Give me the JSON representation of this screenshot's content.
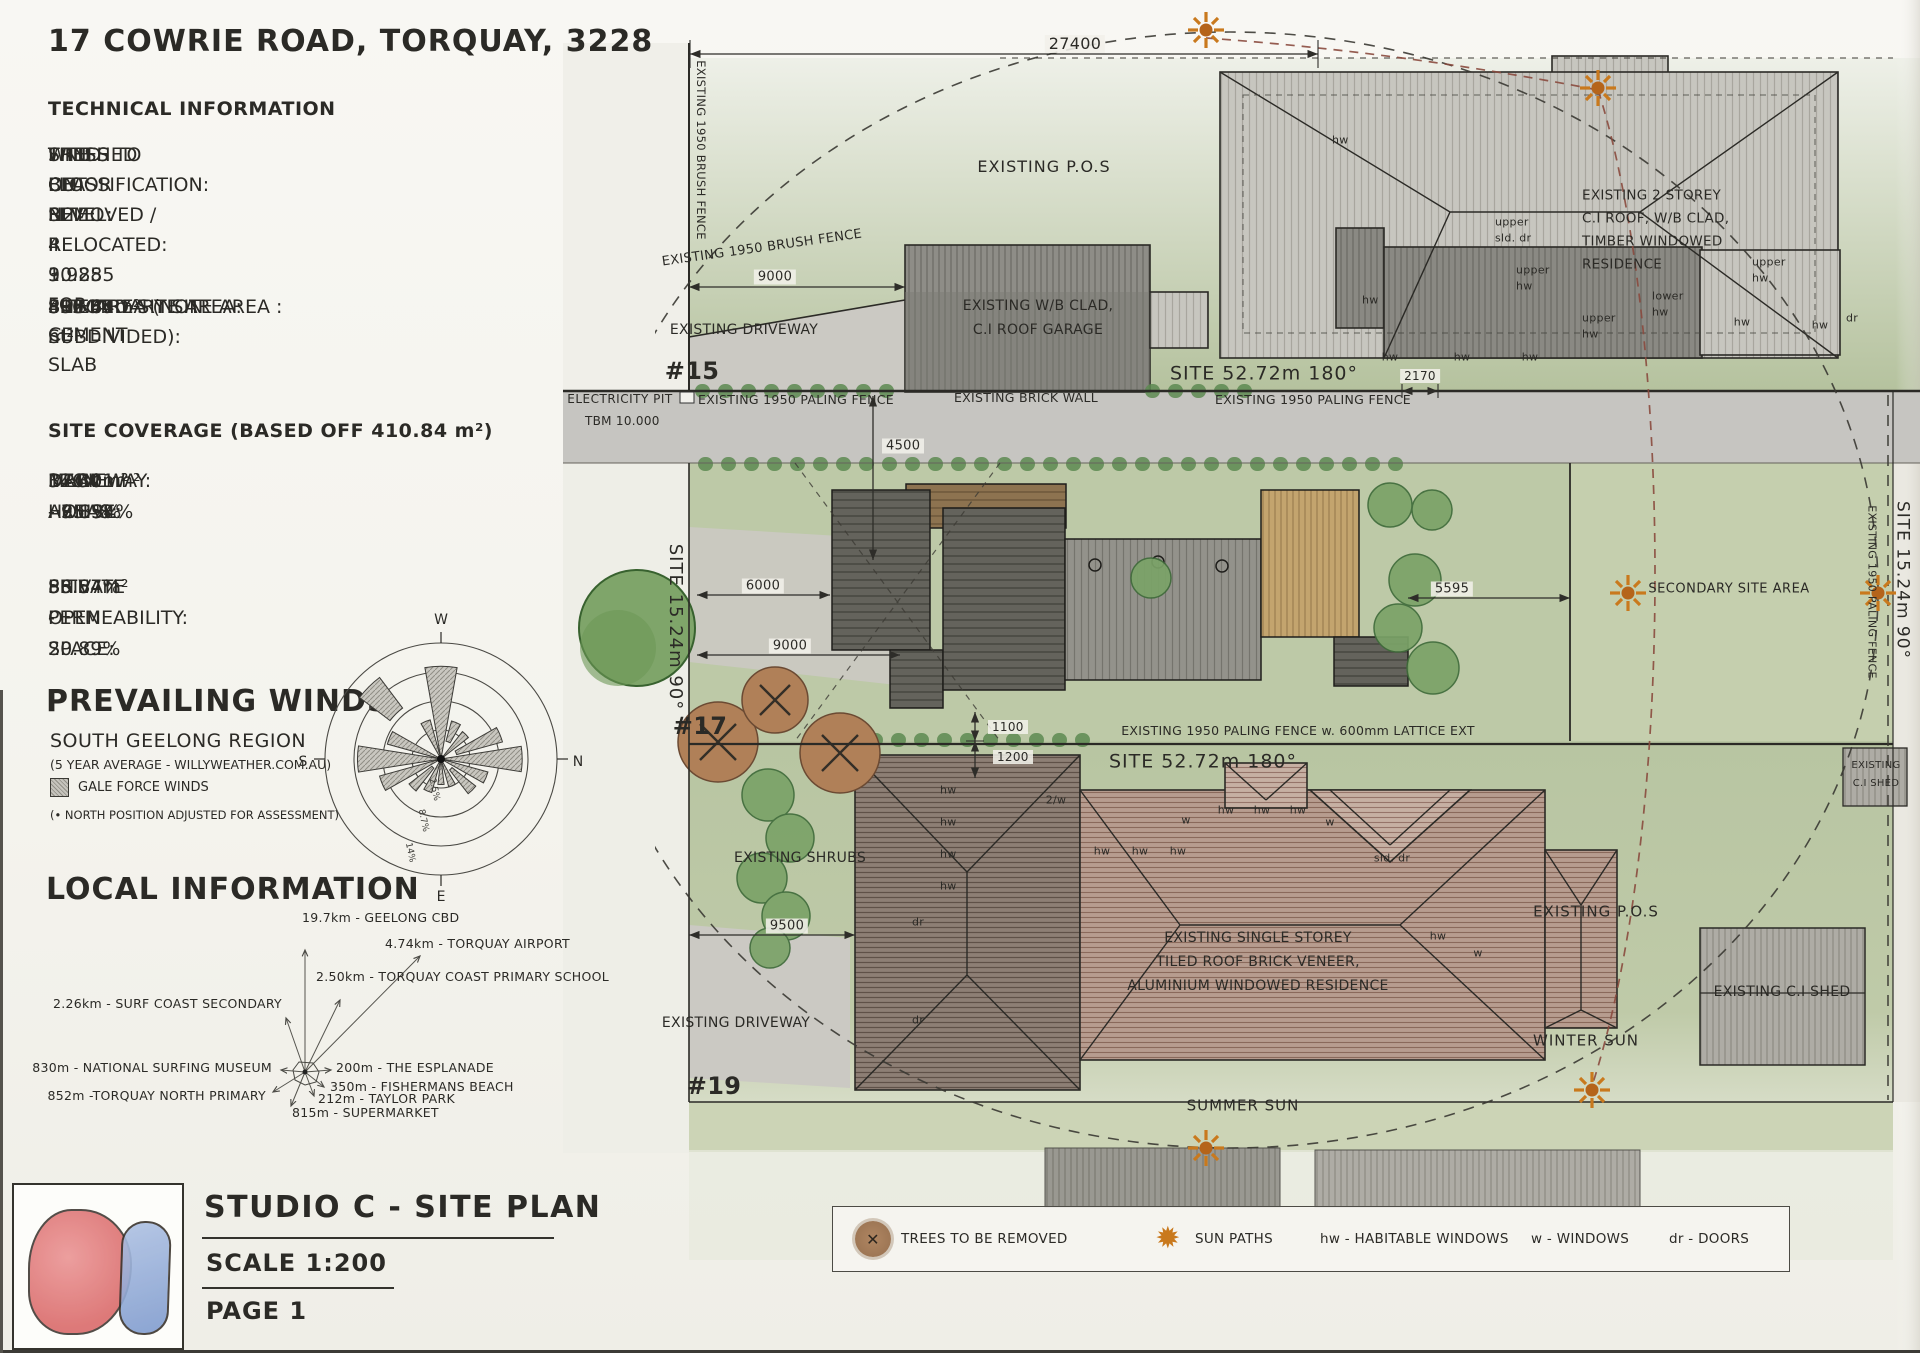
{
  "colors": {
    "paper": "#f6f5f0",
    "ink": "#2b2a26",
    "grass": "#bdc9a7",
    "grass_secondary": "#c5cfae",
    "road": "#c6c5c1",
    "driveway": "#cbc9c3",
    "sun": "#c9791d",
    "sun_core": "#b5641a",
    "sun_path_red": "#8a4a3e",
    "boundary": "#2e2d29",
    "tree_green": "#7fa56a",
    "tree_removed": "#b08058",
    "logo_red": "#db6e6e",
    "logo_blue": "#8fa8d8",
    "legend_bg": "#f4f3ee"
  },
  "sheet": {
    "address_title": "17 COWRIE ROAD, TORQUAY, 3228",
    "technical": {
      "heading": "TECHNICAL INFORMATION",
      "lines": [
        "WIND CLASSIFICATION: N2",
        "SITE CUT LEVEL: RL 9.985 FOR CEMENT SLAB",
        "FINISHED FLOOR LEVEL: RL 10.285",
        "TREES ON SITE: 4",
        "TREES TO BE REMOVED / RELOCATED: 3"
      ]
    },
    "site_areas": {
      "rows": [
        {
          "label": "SITE AREA (NON SUBDIVIDED):",
          "value": "803.45 m²"
        },
        {
          "label": "PRIMARY SITE AREA:",
          "value": "410.84 m²"
        },
        {
          "label": "SECONDARY SITE AREA :",
          "value": "392.61m²"
        }
      ]
    },
    "site_coverage": {
      "heading": "SITE COVERAGE (BASED OFF 410.84 m²)",
      "rows": [
        {
          "label": "MAIN HOUSE:",
          "value": "146.01m² - 35.54%"
        },
        {
          "label": "DECK AREAS:",
          "value": "37.37m² - 9.1%"
        },
        {
          "label": "DRIVEWAY:",
          "value": "32.40m² - 7.89%"
        }
      ],
      "summary_rows": [
        {
          "label": "SITE PERMEABILITY:",
          "value": "56.57%"
        },
        {
          "label": "PRIVATE OPEN SPACE:",
          "value": "85.84m² - 20.89%"
        }
      ]
    },
    "prevailing_winds": {
      "heading": "PREVAILING WINDS",
      "region": "SOUTH GEELONG REGION",
      "source": "(5 YEAR AVERAGE - WILLYWEATHER.COM.AU)",
      "gale_legend": "GALE FORCE WINDS",
      "note": "(• NORTH POSITION ADJUSTED FOR ASSESSMENT)"
    },
    "local_information": {
      "heading": "LOCAL INFORMATION",
      "places": [
        {
          "text": "19.7km - GEELONG CBD",
          "x": 302,
          "y": 918,
          "anchor": "start"
        },
        {
          "text": "4.74km - TORQUAY AIRPORT",
          "x": 385,
          "y": 944,
          "anchor": "start"
        },
        {
          "text": "2.50km - TORQUAY COAST PRIMARY SCHOOL",
          "x": 316,
          "y": 977,
          "anchor": "start"
        },
        {
          "text": "2.26km - SURF COAST SECONDARY",
          "x": 282,
          "y": 1004,
          "anchor": "end"
        },
        {
          "text": "830m - NATIONAL SURFING MUSEUM",
          "x": 272,
          "y": 1068,
          "anchor": "end"
        },
        {
          "text": "200m - THE ESPLANADE",
          "x": 336,
          "y": 1068,
          "anchor": "start"
        },
        {
          "text": "350m - FISHERMANS BEACH",
          "x": 330,
          "y": 1087,
          "anchor": "start"
        },
        {
          "text": "852m -TORQUAY NORTH PRIMARY",
          "x": 266,
          "y": 1096,
          "anchor": "end"
        },
        {
          "text": "212m - TAYLOR PARK",
          "x": 318,
          "y": 1099,
          "anchor": "start"
        },
        {
          "text": "815m - SUPERMARKET",
          "x": 292,
          "y": 1113,
          "anchor": "start"
        }
      ]
    },
    "title_block": {
      "project": "STUDIO C - SITE PLAN",
      "scale": "SCALE 1:200",
      "page": "PAGE 1"
    }
  },
  "wind_rose": {
    "type": "wind-rose",
    "compass": [
      {
        "label": "W",
        "x": 441,
        "y": 624
      },
      {
        "label": "N",
        "x": 578,
        "y": 766
      },
      {
        "label": "E",
        "x": 441,
        "y": 901
      },
      {
        "label": "S",
        "x": 303,
        "y": 766
      }
    ],
    "ring_labels": [
      {
        "t": "2.5%",
        "x": 432,
        "y": 790,
        "r": 78
      },
      {
        "t": "8.7%",
        "x": 421,
        "y": 821,
        "r": 78
      },
      {
        "t": "14%",
        "x": 408,
        "y": 853,
        "r": 78
      }
    ],
    "petals": [
      {
        "a": 0,
        "w": 20,
        "r1": 0.8
      },
      {
        "a": 22.5,
        "r0": 0.16,
        "r1": 0.34
      },
      {
        "a": 45,
        "r1": 0.3
      },
      {
        "a": 67.5,
        "r0": 0.14,
        "r1": 0.55
      },
      {
        "a": 90,
        "w": 18,
        "r1": 0.7
      },
      {
        "a": 112.5,
        "r1": 0.42
      },
      {
        "a": 135,
        "r0": 0.12,
        "r1": 0.38
      },
      {
        "a": 157.5,
        "r1": 0.25
      },
      {
        "a": 180,
        "r1": 0.22
      },
      {
        "a": 202.5,
        "r1": 0.3
      },
      {
        "a": 225,
        "r0": 0.1,
        "r1": 0.35
      },
      {
        "a": 247.5,
        "r1": 0.55
      },
      {
        "a": 270,
        "w": 18,
        "r1": 0.72
      },
      {
        "a": 292.5,
        "r1": 0.48
      },
      {
        "a": 315,
        "w": 16,
        "r0": 0.55,
        "r1": 0.88
      },
      {
        "a": 337.5,
        "r1": 0.35
      }
    ]
  },
  "legend": {
    "items": [
      {
        "icon": "removed-tree",
        "label": "TREES TO BE REMOVED",
        "x": 22
      },
      {
        "icon": "sun",
        "label": "SUN PATHS",
        "x": 318
      },
      {
        "label": "hw - HABITABLE WINDOWS",
        "x": 487
      },
      {
        "label": "w - WINDOWS",
        "x": 698
      },
      {
        "label": "dr - DOORS",
        "x": 836
      }
    ]
  },
  "plan": {
    "labels": [
      {
        "t": "27400",
        "x": 1075,
        "y": 44,
        "fs": 16,
        "c": "dim"
      },
      {
        "t": "EXISTING P.O.S",
        "x": 1044,
        "y": 167,
        "fs": 16,
        "ls": 1
      },
      {
        "t": "EXISTING 1950 BRUSH FENCE",
        "x": 700,
        "y": 150,
        "fs": 11.5,
        "r": 90
      },
      {
        "t": "EXISTING 1950 BRUSH FENCE",
        "x": 762,
        "y": 248,
        "fs": 13,
        "r": -8
      },
      {
        "t": "9000",
        "x": 775,
        "y": 277,
        "fs": 13,
        "c": "dim"
      },
      {
        "t": "EXISTING DRIVEWAY",
        "x": 744,
        "y": 330,
        "fs": 14
      },
      {
        "t": "EXISTING W/B CLAD,",
        "x": 1038,
        "y": 306,
        "fs": 14
      },
      {
        "t": "C.I ROOF GARAGE",
        "x": 1038,
        "y": 330,
        "fs": 14
      },
      {
        "t": "EXISTING 2 STOREY",
        "x": 1582,
        "y": 196,
        "fs": 13.5,
        "a": "start"
      },
      {
        "t": "C.I ROOF, W/B CLAD,",
        "x": 1582,
        "y": 219,
        "fs": 13.5,
        "a": "start"
      },
      {
        "t": "TIMBER WINDOWED",
        "x": 1582,
        "y": 242,
        "fs": 13.5,
        "a": "start"
      },
      {
        "t": "RESIDENCE",
        "x": 1582,
        "y": 265,
        "fs": 13.5,
        "a": "start"
      },
      {
        "t": "hw",
        "x": 1332,
        "y": 140,
        "fs": 11,
        "a": "start"
      },
      {
        "t": "upper",
        "x": 1495,
        "y": 222,
        "fs": 11,
        "a": "start"
      },
      {
        "t": "sld. dr",
        "x": 1495,
        "y": 238,
        "fs": 11,
        "a": "start"
      },
      {
        "t": "upper",
        "x": 1516,
        "y": 270,
        "fs": 11,
        "a": "start"
      },
      {
        "t": "hw",
        "x": 1516,
        "y": 286,
        "fs": 11,
        "a": "start"
      },
      {
        "t": "upper",
        "x": 1752,
        "y": 262,
        "fs": 11,
        "a": "start"
      },
      {
        "t": "hw",
        "x": 1752,
        "y": 278,
        "fs": 11,
        "a": "start"
      },
      {
        "t": "lower",
        "x": 1652,
        "y": 296,
        "fs": 11,
        "a": "start"
      },
      {
        "t": "hw",
        "x": 1652,
        "y": 312,
        "fs": 11,
        "a": "start"
      },
      {
        "t": "upper",
        "x": 1582,
        "y": 318,
        "fs": 11,
        "a": "start"
      },
      {
        "t": "hw",
        "x": 1582,
        "y": 334,
        "fs": 11,
        "a": "start"
      },
      {
        "t": "hw",
        "x": 1362,
        "y": 300,
        "fs": 11,
        "a": "start"
      },
      {
        "t": "hw",
        "x": 1390,
        "y": 357,
        "fs": 11
      },
      {
        "t": "hw",
        "x": 1462,
        "y": 357,
        "fs": 11
      },
      {
        "t": "hw",
        "x": 1530,
        "y": 357,
        "fs": 11
      },
      {
        "t": "hw",
        "x": 1742,
        "y": 322,
        "fs": 11
      },
      {
        "t": "hw",
        "x": 1820,
        "y": 325,
        "fs": 11
      },
      {
        "t": "dr",
        "x": 1852,
        "y": 318,
        "fs": 11
      },
      {
        "t": "2170",
        "x": 1420,
        "y": 376,
        "fs": 12,
        "c": "dim"
      },
      {
        "t": "SITE 52.72m 180°",
        "x": 1264,
        "y": 374,
        "fs": 19,
        "ls": 1
      },
      {
        "t": "#15",
        "x": 692,
        "y": 371,
        "fs": 24,
        "c": "big"
      },
      {
        "t": "ELECTRICITY PIT",
        "x": 620,
        "y": 399,
        "fs": 12,
        "ls": 0.5
      },
      {
        "t": "TBM 10.000",
        "x": 585,
        "y": 421,
        "fs": 12,
        "a": "start"
      },
      {
        "t": "EXISTING 1950 PALING FENCE",
        "x": 796,
        "y": 400,
        "fs": 12.5
      },
      {
        "t": "EXISTING BRICK WALL",
        "x": 1026,
        "y": 398,
        "fs": 12.5
      },
      {
        "t": "EXISTING 1950 PALING FENCE",
        "x": 1313,
        "y": 400,
        "fs": 12.5
      },
      {
        "t": "4500",
        "x": 882,
        "y": 446,
        "fs": 13,
        "a": "start",
        "c": "dim"
      },
      {
        "t": "SITE 15.24m 90°",
        "x": 675,
        "y": 627,
        "fs": 18,
        "r": 90,
        "ls": 1
      },
      {
        "t": "6000",
        "x": 763,
        "y": 586,
        "fs": 13,
        "c": "dim"
      },
      {
        "t": "9000",
        "x": 790,
        "y": 646,
        "fs": 13,
        "c": "dim"
      },
      {
        "t": "5595",
        "x": 1452,
        "y": 589,
        "fs": 13,
        "c": "dim"
      },
      {
        "t": "SECONDARY SITE AREA",
        "x": 1729,
        "y": 589,
        "fs": 13,
        "ls": 0.5
      },
      {
        "t": "SITE 15.24m 90°",
        "x": 1902,
        "y": 580,
        "fs": 17,
        "r": 90,
        "ls": 1
      },
      {
        "t": "EXISTING 1950 PALING FENCE",
        "x": 1872,
        "y": 592,
        "fs": 11,
        "r": 90
      },
      {
        "t": "#17",
        "x": 700,
        "y": 726,
        "fs": 24,
        "c": "big"
      },
      {
        "t": "EXISTING 1950 PALING FENCE w. 600mm LATTICE EXT",
        "x": 1298,
        "y": 731,
        "fs": 12.5
      },
      {
        "t": "SITE 52.72m 180°",
        "x": 1203,
        "y": 762,
        "fs": 19,
        "ls": 1
      },
      {
        "t": "1100",
        "x": 988,
        "y": 727,
        "fs": 12,
        "a": "start",
        "c": "dim"
      },
      {
        "t": "1200",
        "x": 993,
        "y": 757,
        "fs": 12,
        "a": "start",
        "c": "dim"
      },
      {
        "t": "EXISTING SHRUBS",
        "x": 800,
        "y": 858,
        "fs": 14
      },
      {
        "t": "9500",
        "x": 787,
        "y": 926,
        "fs": 13,
        "c": "dim"
      },
      {
        "t": "EXISTING DRIVEWAY",
        "x": 736,
        "y": 1023,
        "fs": 14
      },
      {
        "t": "#19",
        "x": 714,
        "y": 1086,
        "fs": 24,
        "c": "big"
      },
      {
        "t": "hw",
        "x": 940,
        "y": 790,
        "fs": 11,
        "a": "start"
      },
      {
        "t": "hw",
        "x": 940,
        "y": 822,
        "fs": 11,
        "a": "start"
      },
      {
        "t": "hw",
        "x": 940,
        "y": 854,
        "fs": 11,
        "a": "start"
      },
      {
        "t": "hw",
        "x": 940,
        "y": 886,
        "fs": 11,
        "a": "start"
      },
      {
        "t": "dr",
        "x": 912,
        "y": 922,
        "fs": 11,
        "a": "start"
      },
      {
        "t": "dr",
        "x": 912,
        "y": 1020,
        "fs": 11,
        "a": "start"
      },
      {
        "t": "2/w",
        "x": 1056,
        "y": 800,
        "fs": 11
      },
      {
        "t": "hw",
        "x": 1102,
        "y": 851,
        "fs": 11
      },
      {
        "t": "hw",
        "x": 1140,
        "y": 851,
        "fs": 11
      },
      {
        "t": "hw",
        "x": 1178,
        "y": 851,
        "fs": 11
      },
      {
        "t": "w",
        "x": 1186,
        "y": 820,
        "fs": 11
      },
      {
        "t": "hw",
        "x": 1226,
        "y": 810,
        "fs": 11
      },
      {
        "t": "hw",
        "x": 1262,
        "y": 810,
        "fs": 11
      },
      {
        "t": "hw",
        "x": 1298,
        "y": 810,
        "fs": 11
      },
      {
        "t": "w",
        "x": 1330,
        "y": 822,
        "fs": 11
      },
      {
        "t": "sld. dr",
        "x": 1392,
        "y": 858,
        "fs": 11
      },
      {
        "t": "hw",
        "x": 1438,
        "y": 936,
        "fs": 11
      },
      {
        "t": "w",
        "x": 1478,
        "y": 953,
        "fs": 11
      },
      {
        "t": "EXISTING SINGLE STOREY",
        "x": 1258,
        "y": 938,
        "fs": 14
      },
      {
        "t": "TILED ROOF BRICK VENEER,",
        "x": 1258,
        "y": 962,
        "fs": 14
      },
      {
        "t": "ALUMINIUM WINDOWED RESIDENCE",
        "x": 1258,
        "y": 986,
        "fs": 14
      },
      {
        "t": "EXISTING P.O.S",
        "x": 1596,
        "y": 912,
        "fs": 15,
        "ls": 1
      },
      {
        "t": "WINTER SUN",
        "x": 1586,
        "y": 1041,
        "fs": 15,
        "ls": 1
      },
      {
        "t": "SUMMER SUN",
        "x": 1243,
        "y": 1106,
        "fs": 15,
        "ls": 1
      },
      {
        "t": "EXISTING C.I SHED",
        "x": 1782,
        "y": 992,
        "fs": 14
      },
      {
        "t": "EXISTING",
        "x": 1876,
        "y": 766,
        "fs": 10
      },
      {
        "t": "C.I SHED",
        "x": 1876,
        "y": 784,
        "fs": 10
      }
    ]
  }
}
